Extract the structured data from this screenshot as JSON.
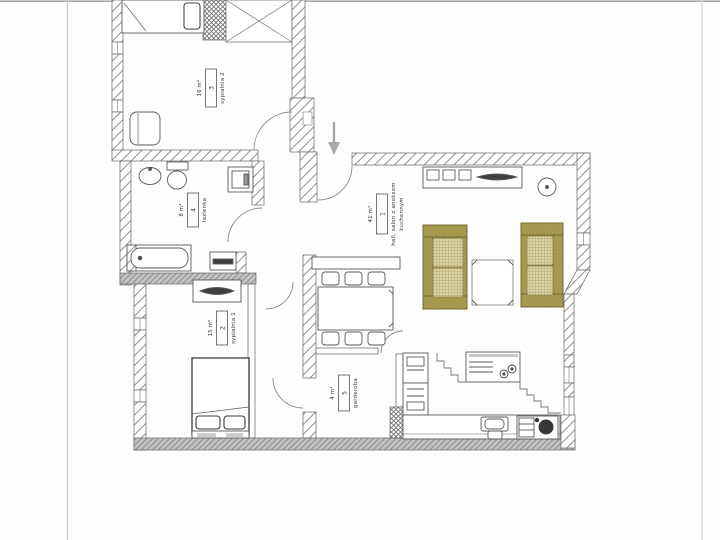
{
  "rooms": [
    {
      "number": "1",
      "name_line1": "hall, salon z aneksem",
      "name_line2": "kuchennym",
      "area": "41 m²"
    },
    {
      "number": "2",
      "name_line1": "sypialnia 1",
      "area": "15 m²"
    },
    {
      "number": "3",
      "name_line1": "sypialnia 2",
      "area": "16 m²"
    },
    {
      "number": "4",
      "name_line1": "łazienka",
      "area": "8 m²"
    },
    {
      "number": "5",
      "name_line1": "garderoba",
      "area": "4 m²"
    }
  ],
  "icons": {
    "entrance_arrow": "↓"
  },
  "colors": {
    "sofa": "#b3a355",
    "sofa_cushion": "#ddd3a6",
    "wall_line": "#555555",
    "scan_edge": "#c8c8c8",
    "accent_dark": "#3f3f3f"
  }
}
